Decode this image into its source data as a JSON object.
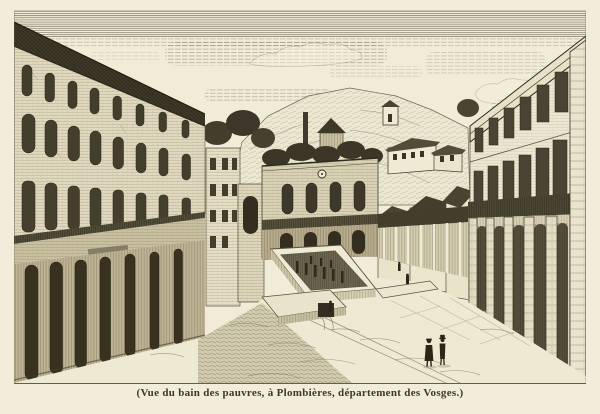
{
  "engraving": {
    "caption": "(Vue du bain des pauvres, à Plombières, département des Vosges.)",
    "subject": "Bain des pauvres",
    "location": "Plombières, département des Vosges",
    "alt": "Engraved street view of a town square: tall buildings with rows of arched windows on the left, a colonnaded building on the right, a central bath house, a sunken rectangular public bath with small columns, wooded hills and small houses behind, and two small figures standing in the foreground square."
  },
  "colors": {
    "paper": "#f1edda",
    "ink": "#3e3827",
    "roof_dark": "#3e3828",
    "mid_tone": "#8a8168"
  }
}
